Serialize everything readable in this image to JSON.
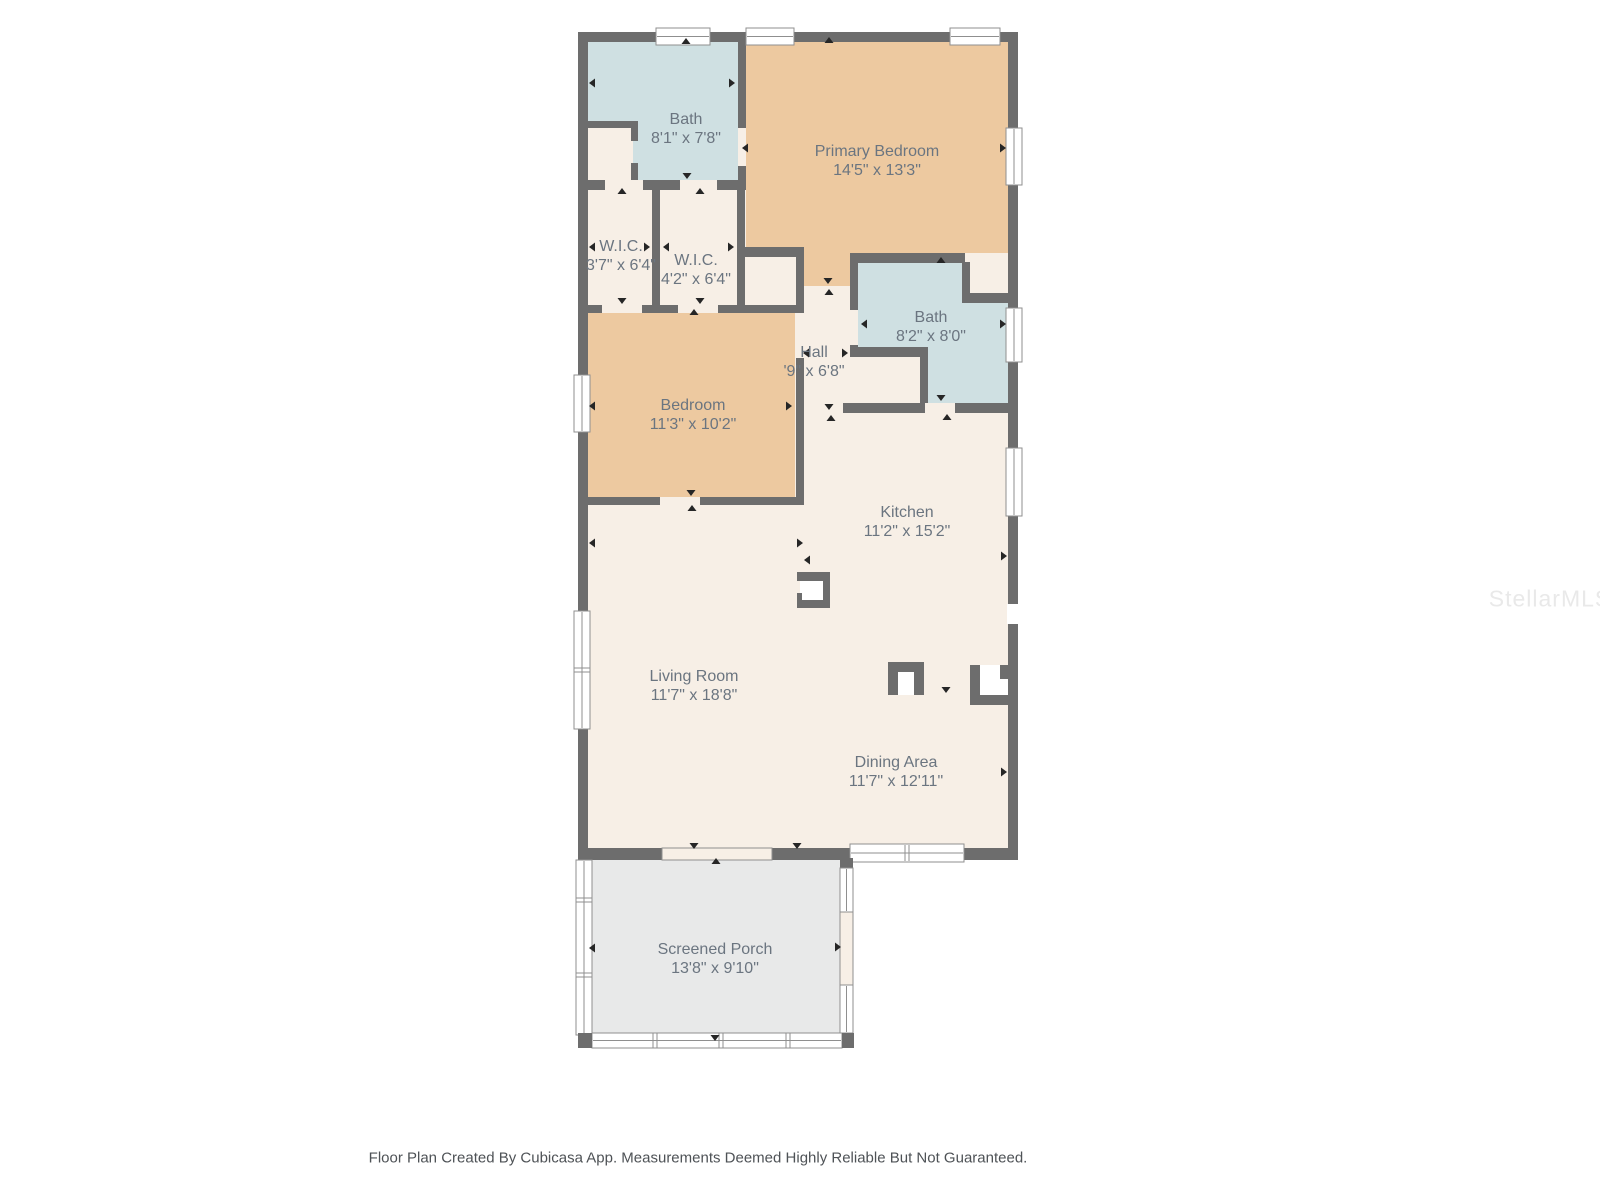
{
  "watermark": "StellarMLS",
  "footer": "Floor Plan Created By Cubicasa App. Measurements Deemed Highly Reliable But Not Guaranteed.",
  "colors": {
    "wall": "#6d6d6d",
    "room_cream": "#f7efe6",
    "room_tan": "#edc9a0",
    "room_blue": "#cfe0e2",
    "porch_gray": "#e8e9e9",
    "window_white": "#ffffff",
    "window_frame": "#8f8f8f",
    "label_text": "#6b7580",
    "footer_text": "#4e5256",
    "watermark_text": "#e9e9e9",
    "arrow": "#262626",
    "background": "#ffffff"
  },
  "rooms": [
    {
      "id": "bath-1",
      "name": "Bath",
      "dims": "8'1\" x 7'8\""
    },
    {
      "id": "primary-bedroom",
      "name": "Primary Bedroom",
      "dims": "14'5\" x 13'3\""
    },
    {
      "id": "wic-1",
      "name": "W.I.C.",
      "dims": "3'7\" x 6'4\""
    },
    {
      "id": "wic-2",
      "name": "W.I.C.",
      "dims": "4'2\" x 6'4\""
    },
    {
      "id": "bath-2",
      "name": "Bath",
      "dims": "8'2\" x 8'0\""
    },
    {
      "id": "hall",
      "name": "Hall",
      "dims": "'9\" x 6'8\""
    },
    {
      "id": "bedroom",
      "name": "Bedroom",
      "dims": "11'3\" x 10'2\""
    },
    {
      "id": "kitchen",
      "name": "Kitchen",
      "dims": "11'2\" x 15'2\""
    },
    {
      "id": "living-room",
      "name": "Living Room",
      "dims": "11'7\" x 18'8\""
    },
    {
      "id": "dining-area",
      "name": "Dining Area",
      "dims": "11'7\" x 12'11\""
    },
    {
      "id": "screened-porch",
      "name": "Screened Porch",
      "dims": "13'8\" x 9'10\""
    }
  ]
}
